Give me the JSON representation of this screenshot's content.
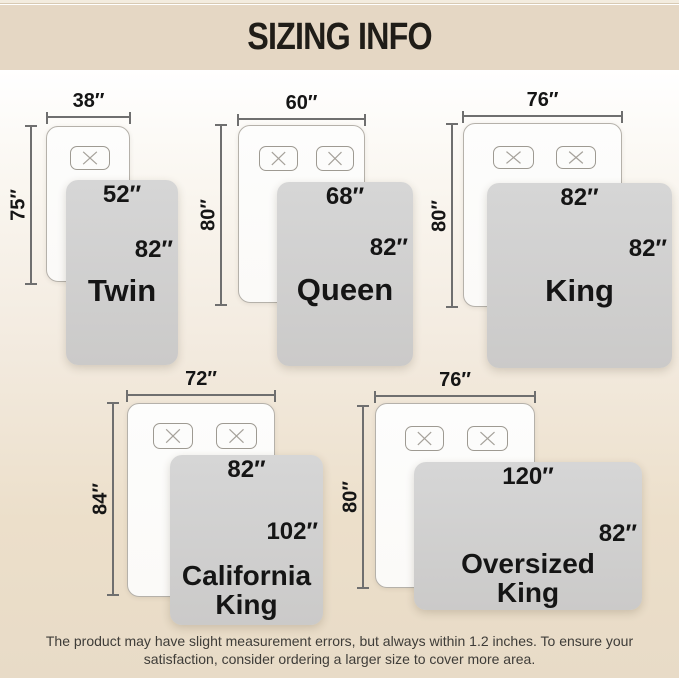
{
  "header": {
    "title": "SIZING INFO"
  },
  "sizes": [
    {
      "label": "Twin",
      "bed_width": "38″",
      "bed_length": "75″",
      "blanket_width": "52″",
      "blanket_length": "82″",
      "pillows": 1
    },
    {
      "label": "Queen",
      "bed_width": "60″",
      "bed_length": "80″",
      "blanket_width": "68″",
      "blanket_length": "82″",
      "pillows": 2
    },
    {
      "label": "King",
      "bed_width": "76″",
      "bed_length": "80″",
      "blanket_width": "82″",
      "blanket_length": "82″",
      "pillows": 2
    },
    {
      "label": "California\nKing",
      "bed_width": "72″",
      "bed_length": "84″",
      "blanket_width": "82″",
      "blanket_length": "102″",
      "pillows": 2
    },
    {
      "label": "Oversized\nKing",
      "bed_width": "76″",
      "bed_length": "80″",
      "blanket_width": "120″",
      "blanket_length": "82″",
      "pillows": 2
    }
  ],
  "footer": {
    "text": "The product may have slight measurement errors, but always within 1.2 inches. To ensure your\nsatisfaction, consider ordering a larger size to cover more area."
  },
  "colors": {
    "header_band": "#e5d7c4",
    "top_strip": "#f3ecdf",
    "title_text": "#201d18",
    "background_top": "#ffffff",
    "background_bottom": "#e8dbc7",
    "bed_fill": "#fbfaf8",
    "bed_border": "#b5b1aa",
    "pillow_border": "#9e9a92",
    "blanket_fill": "#d2d2d2",
    "dimension_line": "#6f6f6f",
    "label_text": "#151515",
    "footer_text": "#3e3c38"
  }
}
